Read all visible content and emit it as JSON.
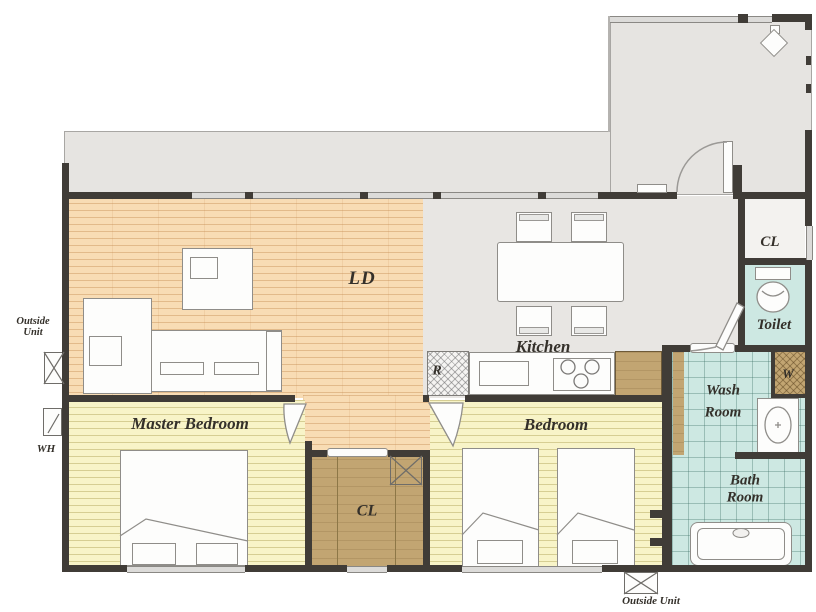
{
  "title": "apartment-floor-plan",
  "labels": {
    "ld": "LD",
    "kitchen": "Kitchen",
    "master_bedroom": "Master Bedroom",
    "bedroom": "Bedroom",
    "closet_center": "CL",
    "closet_entry": "CL",
    "toilet": "Toilet",
    "wash_room_line1": "Wash",
    "wash_room_line2": "Room",
    "bath_room_line1": "Bath",
    "bath_room_line2": "Room",
    "refrigerator": "R",
    "washer": "W",
    "water_heater": "WH",
    "outside_unit_line1": "Outside",
    "outside_unit_line2": "Unit",
    "outside_unit_bottom": "Outside Unit"
  },
  "colors": {
    "wood_floor": "#f8dcb4",
    "bedroom_floor": "#f8f4c8",
    "closet_floor": "#c2a572",
    "wet_area_floor": "#cde8e2",
    "outdoor_floor": "#e6e4e1",
    "kitchen_floor": "#e8e6e3",
    "wall": "#403c37",
    "label_text": "#34302a"
  }
}
